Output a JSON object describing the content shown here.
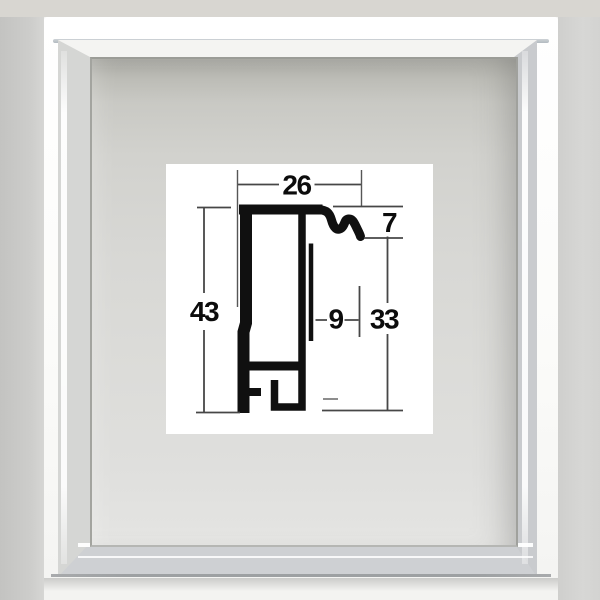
{
  "image_type": "product photo with technical drawing",
  "subject": "empty silver aluminum shadow-box picture frame, front view, with cross-section profile diagram on white card",
  "diagram": {
    "type": "cross-section profile drawing",
    "labels": {
      "top_width": "26",
      "front_lip_height": "7",
      "overall_height": "43",
      "inner_offset": "9",
      "back_height": "33"
    },
    "units_shown": false,
    "ink_color": "#101010",
    "dimension_line_color": "#474747",
    "card_background": "#ffffff"
  },
  "frame_photo": {
    "finish": "silver",
    "face_color": "#fbfbf9",
    "metal_band_color": "#c9cbce",
    "cavity_color": "#d8d8d5",
    "backdrop_left_color": "#c9c9c7",
    "backdrop_right_color": "#d4d4d2",
    "backdrop_top_color": "#d8d6d1"
  }
}
